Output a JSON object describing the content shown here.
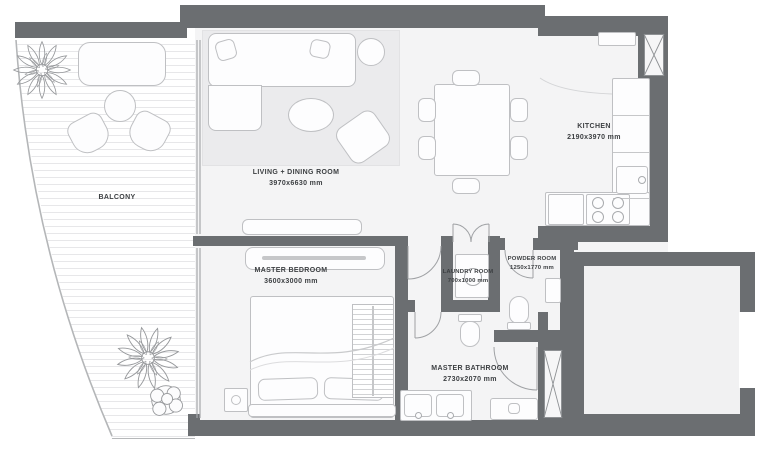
{
  "plan": {
    "rooms": [
      {
        "id": "balcony",
        "label": "BALCONY",
        "dims": ""
      },
      {
        "id": "living_dining",
        "label": "LIVING + DINING ROOM",
        "dims": "3970x6630 mm"
      },
      {
        "id": "kitchen",
        "label": "KITCHEN",
        "dims": "2190x3970 mm"
      },
      {
        "id": "master_bedroom",
        "label": "MASTER BEDROOM",
        "dims": "3600x3000 mm"
      },
      {
        "id": "laundry",
        "label": "LAUNDRY ROOM",
        "dims": "700x1000 mm"
      },
      {
        "id": "powder",
        "label": "POWDER ROOM",
        "dims": "1250x1770 mm"
      },
      {
        "id": "master_bathroom",
        "label": "MASTER BATHROOM",
        "dims": "2730x2070 mm"
      }
    ],
    "colors": {
      "wall": "#6b6e71",
      "floor": "#f4f4f5",
      "line": "#bfc0c3",
      "text": "#3c3f42"
    }
  }
}
